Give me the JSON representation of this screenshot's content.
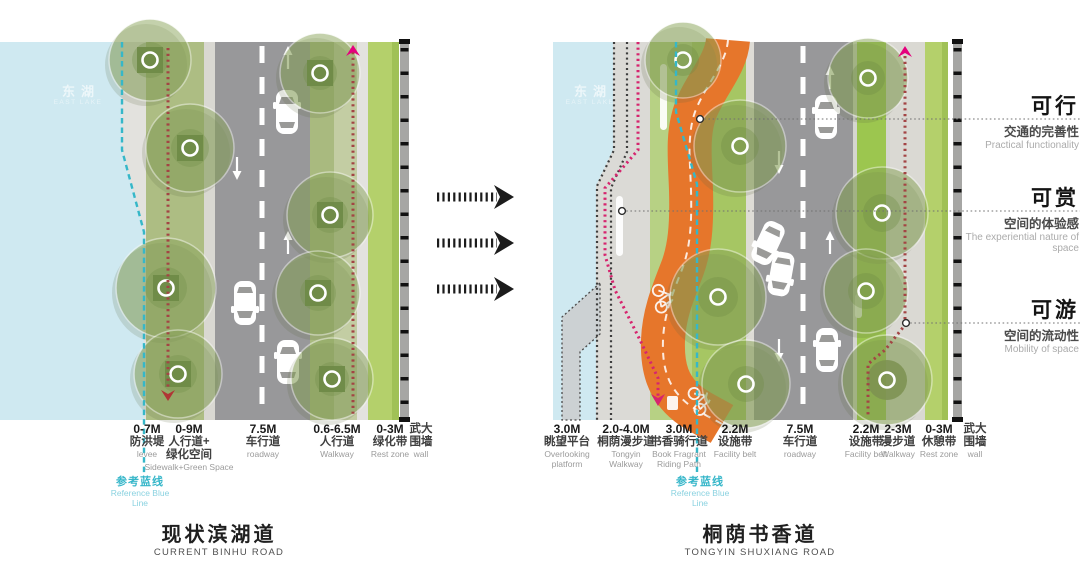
{
  "colors": {
    "water": "#cfe9f1",
    "walkway_gray": "#e3e2de",
    "lawn_olive": "#adbd83",
    "roadway_gray": "#98989a",
    "bright_green_strip": "#b4d06b",
    "facility_green": "#9cc64f",
    "orange_riding_path": "#e6762b",
    "teal_reference_line": "#36b7c8",
    "magenta_route_line": "#d6246e",
    "dark_red_route_line": "#a34444",
    "wall_gray": "#a6a6a4"
  },
  "left_diagram": {
    "water_label_zh": "东湖",
    "water_label_en": "EAST LAKE",
    "labels": [
      {
        "dim": "0-7M",
        "zh": "防洪堤",
        "en": "levee"
      },
      {
        "dim": "0-9M",
        "zh": "人行道+\n绿化空间",
        "en": "Sidewalk+Green Space"
      },
      {
        "dim": "7.5M",
        "zh": "车行道",
        "en": "roadway"
      },
      {
        "dim": "0.6-6.5M",
        "zh": "人行道",
        "en": "Walkway"
      },
      {
        "dim": "0-3M",
        "zh": "绿化带",
        "en": "Rest zone"
      },
      {
        "dim": "",
        "zh": "武大\n围墙",
        "en": "wall"
      }
    ],
    "reference_line_zh": "参考蓝线",
    "reference_line_en": "Reference Blue\nLine",
    "title_zh": "现状滨湖道",
    "title_en": "CURRENT BINHU ROAD"
  },
  "right_diagram": {
    "water_label_zh": "东湖",
    "water_label_en": "EAST LAKE",
    "labels": [
      {
        "dim": "3.0M",
        "zh": "眺望平台",
        "en": "Overlooking\nplatform"
      },
      {
        "dim": "2.0-4.0M",
        "zh": "桐荫漫步道",
        "en": "Tongyin\nWalkway"
      },
      {
        "dim": "3.0M",
        "zh": "书香骑行道",
        "en": "Book Fragrant\nRiding Path"
      },
      {
        "dim": "2.2M",
        "zh": "设施带",
        "en": "Facility belt"
      },
      {
        "dim": "7.5M",
        "zh": "车行道",
        "en": "roadway"
      },
      {
        "dim": "2.2M",
        "zh": "设施带",
        "en": "Facility belt"
      },
      {
        "dim": "2-3M",
        "zh": "漫步道",
        "en": "Walkway"
      },
      {
        "dim": "0-3M",
        "zh": "休憩带",
        "en": "Rest zone"
      },
      {
        "dim": "",
        "zh": "武大\n围墙",
        "en": "wall"
      }
    ],
    "reference_line_zh": "参考蓝线",
    "reference_line_en": "Reference Blue\nLine",
    "title_zh": "桐荫书香道",
    "title_en": "TONGYIN SHUXIANG ROAD"
  },
  "annotations": [
    {
      "title": "可行",
      "zh": "交通的完善性",
      "en": "Practical functionality"
    },
    {
      "title": "可赏",
      "zh": "空间的体验感",
      "en": "The experiential nature of space"
    },
    {
      "title": "可游",
      "zh": "空间的流动性",
      "en": "Mobility of space"
    }
  ]
}
